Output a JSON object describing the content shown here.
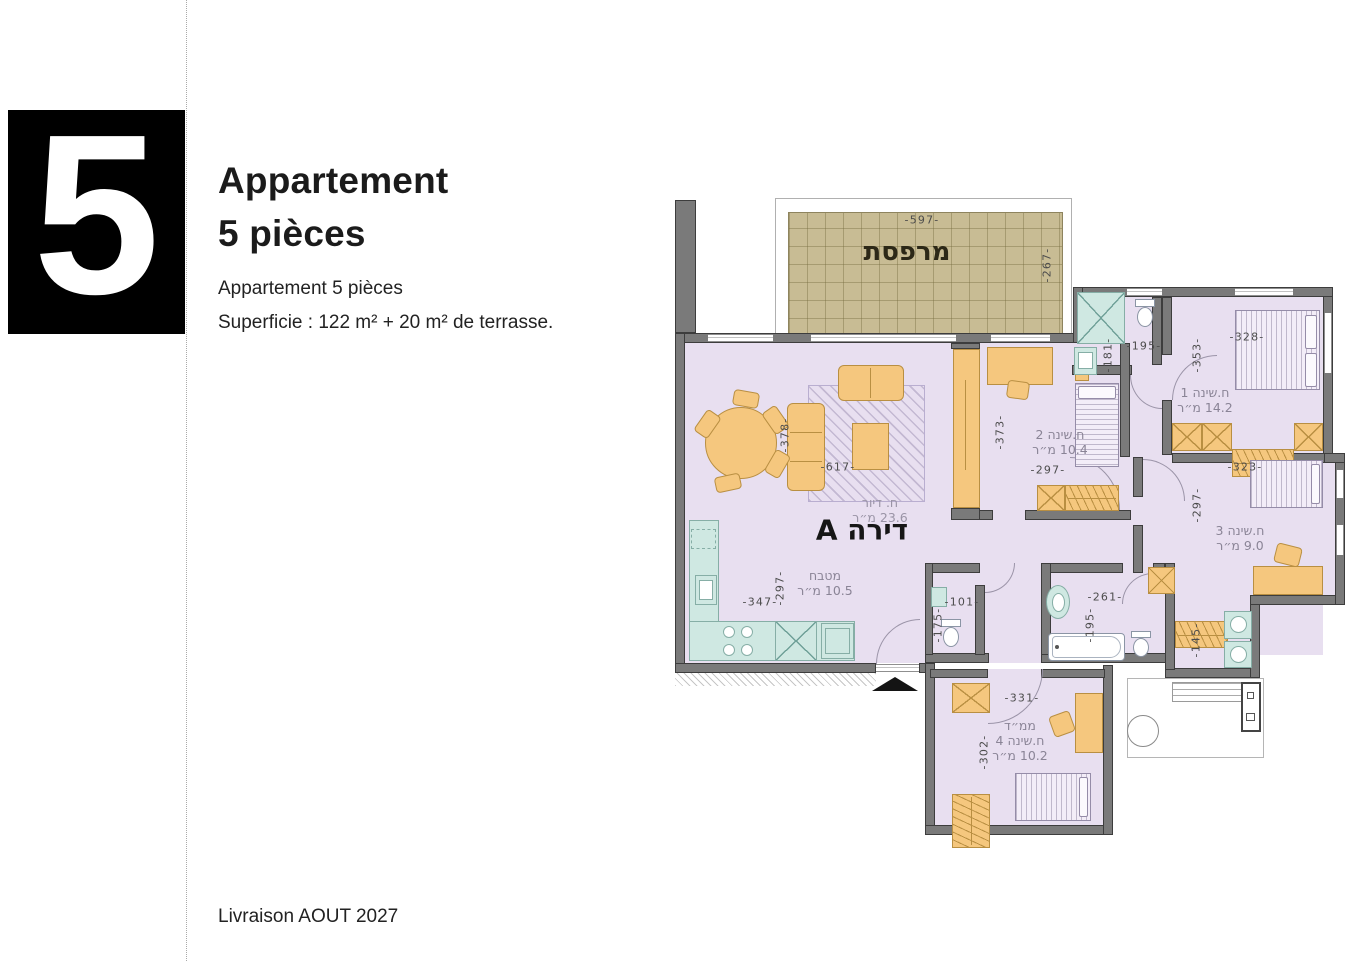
{
  "page": {
    "number": "5",
    "title_line1": "Appartement",
    "title_line2": "5 pièces",
    "subtitle": "Appartement 5 pièces",
    "area_line": "Superficie : 122 m² + 20 m² de terrasse.",
    "delivery": "Livraison AOUT 2027"
  },
  "colors": {
    "wall": "#7a7a7a",
    "floor": "#e8dff0",
    "furniture": "#f5c77e",
    "fixture": "#cfe8e2",
    "terrace": "#c8bc94",
    "number_box": "#000000"
  },
  "plan": {
    "apartment_label": "דירה A",
    "terrace": {
      "label": "מרפסת"
    },
    "rooms": {
      "living": {
        "name": "ח. דיור",
        "area": "23.6 מ״ר"
      },
      "kitchen": {
        "name": "מטבח",
        "area": "10.5 מ״ר"
      },
      "bed1": {
        "name": "ח.שינה 1",
        "area": "14.2 מ״ר"
      },
      "bed2": {
        "name": "ח.שינה 2",
        "area": "10.4 מ״ר"
      },
      "bed3": {
        "name": "ח.שינה 3",
        "area": "9.0 מ״ר"
      },
      "bed4": {
        "prefix": "ממ״ד",
        "name": "ח.שינה 4",
        "area": "10.2 מ״ר"
      }
    },
    "dims": {
      "terrace_w": "-597-",
      "terrace_d": "-267-",
      "living_w": "-617-",
      "living_d": "-378-",
      "bed2_d": "-373-",
      "bed2_w": "-297-",
      "shower_d": "-181-",
      "shower_w": "-195-",
      "bed1_d": "-353-",
      "bed1_w": "-328-",
      "bed3_w": "-323-",
      "bed3_d": "-297-",
      "kitchen_w": "-347-",
      "kitchen_d": "-297-",
      "wc_w": "-101-",
      "wc_d": "-175-",
      "bath_w": "-261-",
      "bath_d": "-195-",
      "laundry_d": "-145-",
      "bed4_w": "-331-",
      "bed4_d": "-302-"
    }
  }
}
